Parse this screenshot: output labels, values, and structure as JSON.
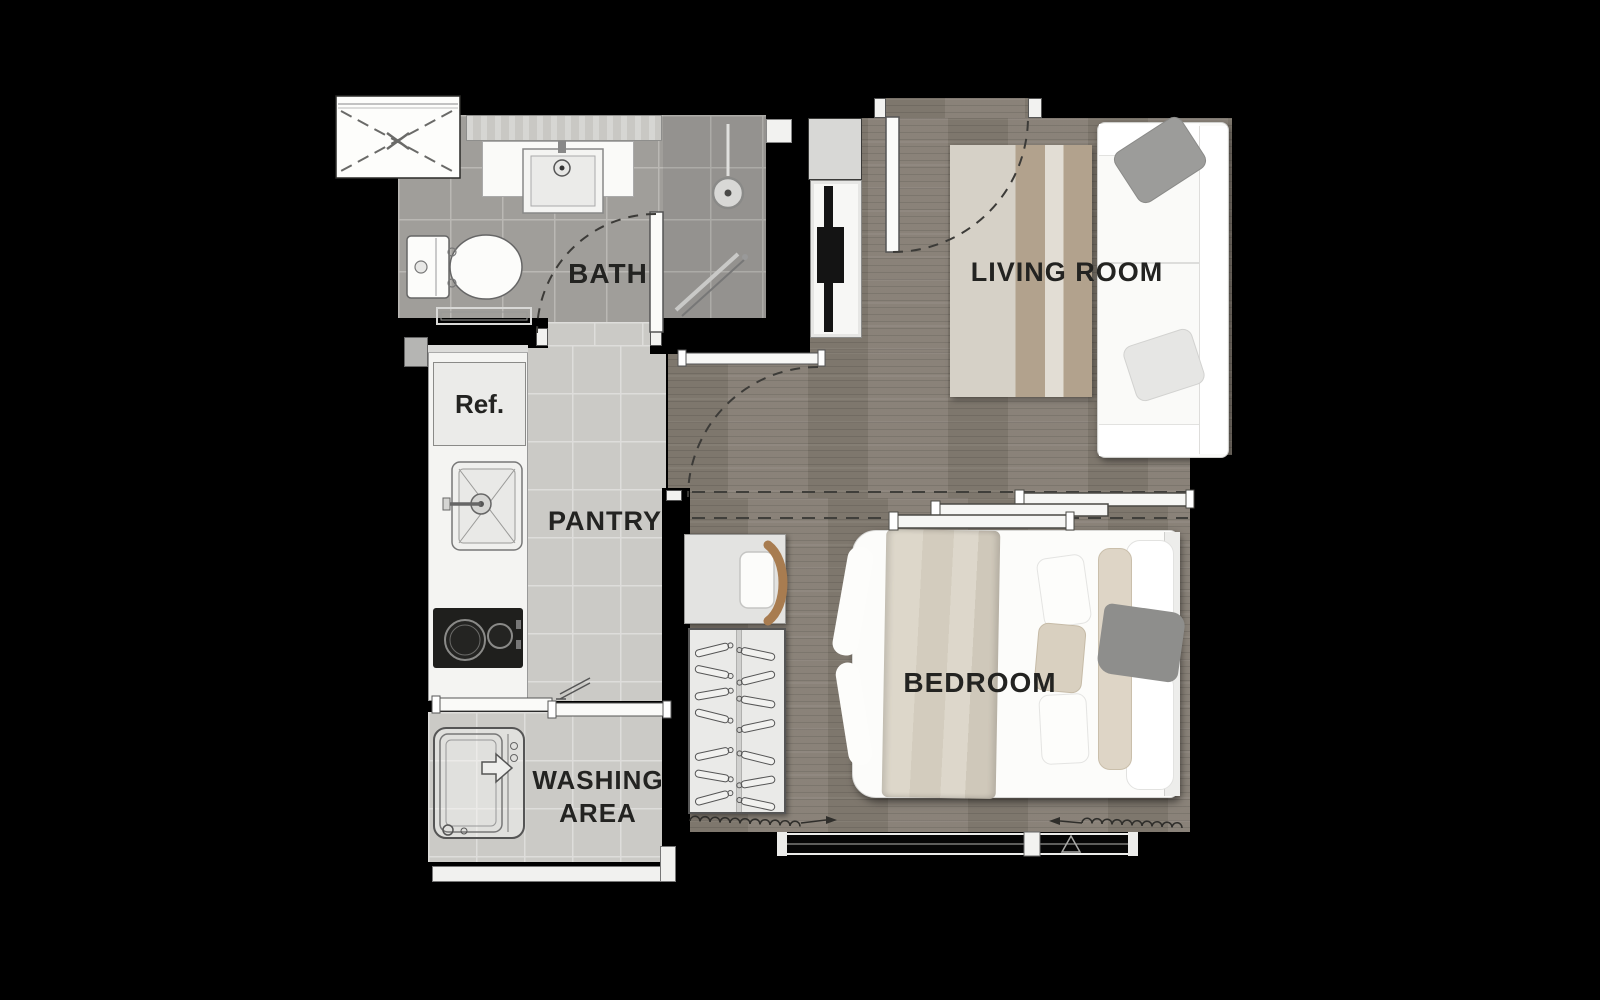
{
  "meta": {
    "type": "architectural floor plan",
    "unit": "one-bedroom condominium unit"
  },
  "rooms": [
    {
      "id": "bath",
      "label": "BATH"
    },
    {
      "id": "living_room",
      "label": "LIVING ROOM"
    },
    {
      "id": "pantry",
      "label": "PANTRY"
    },
    {
      "id": "bedroom",
      "label": "BEDROOM"
    },
    {
      "id": "washing_area",
      "label": "WASHING AREA"
    }
  ],
  "appliances": {
    "refrigerator_label": "Ref."
  },
  "fixtures": {
    "bath": [
      "vanity-counter",
      "washbasin",
      "toilet",
      "shower-drain",
      "towel-rail",
      "swing-door"
    ],
    "entry": [
      "entrance-door",
      "door-swing-arc",
      "tv-console",
      "television"
    ],
    "living_room": [
      "sofa",
      "cushions",
      "area-rug"
    ],
    "pantry": [
      "refrigerator",
      "kitchen-sink",
      "two-burner-stove",
      "counter"
    ],
    "bedroom": [
      "double-bed",
      "pillows",
      "throw-blanket",
      "desk",
      "chair",
      "wardrobe-with-hangers",
      "sliding-partition",
      "window",
      "curtain-symbols"
    ],
    "washing_area": [
      "washing-machine",
      "sliding-door"
    ],
    "exterior": [
      "ac-ledge"
    ]
  },
  "colors": {
    "background": "#000000",
    "wall": "#000000",
    "wood_floor": "#867e74",
    "bath_tile": "#a09e9a",
    "pantry_tile": "#cbcac6",
    "fixture_white": "#f6f6f4",
    "rug_cream": "#d6d1c7",
    "rug_tan": "#b2a28d",
    "textile_beige": "#d8d2c5",
    "chair_wood": "#a87c50",
    "label_text": "#232321"
  }
}
